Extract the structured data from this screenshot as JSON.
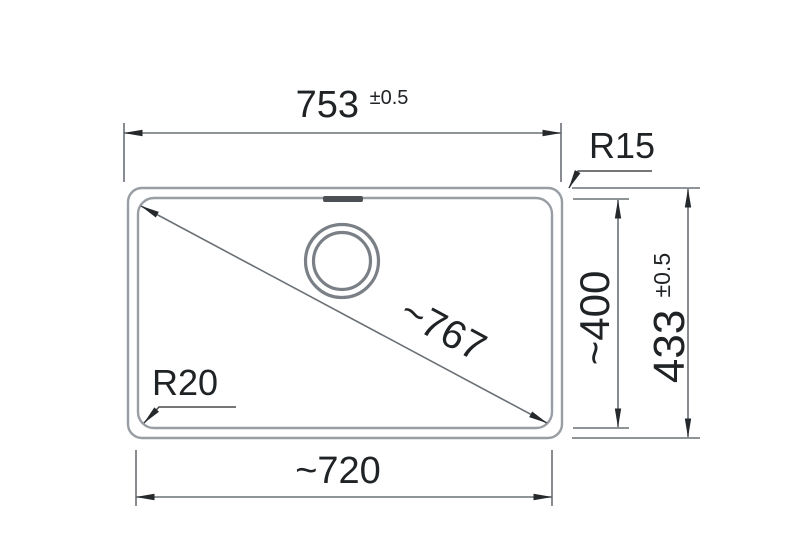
{
  "diagram": {
    "labels": {
      "top_width_value": "753",
      "top_width_tolerance": "±0.5",
      "radius_top_right": "R15",
      "inner_height": "~400",
      "outer_height_value": "433",
      "outer_height_tolerance": "±0.5",
      "diagonal": "~767",
      "radius_bottom_left": "R20",
      "inner_width": "~720"
    },
    "colors": {
      "background": "#ffffff",
      "outline": "#989ea3",
      "drain_ring": "#7a8086",
      "overflow_slot": "#4c5054",
      "dimension_line": "#6a7075",
      "leader_line": "#46494c",
      "text": "#202325",
      "arrow": "#26292c"
    }
  }
}
